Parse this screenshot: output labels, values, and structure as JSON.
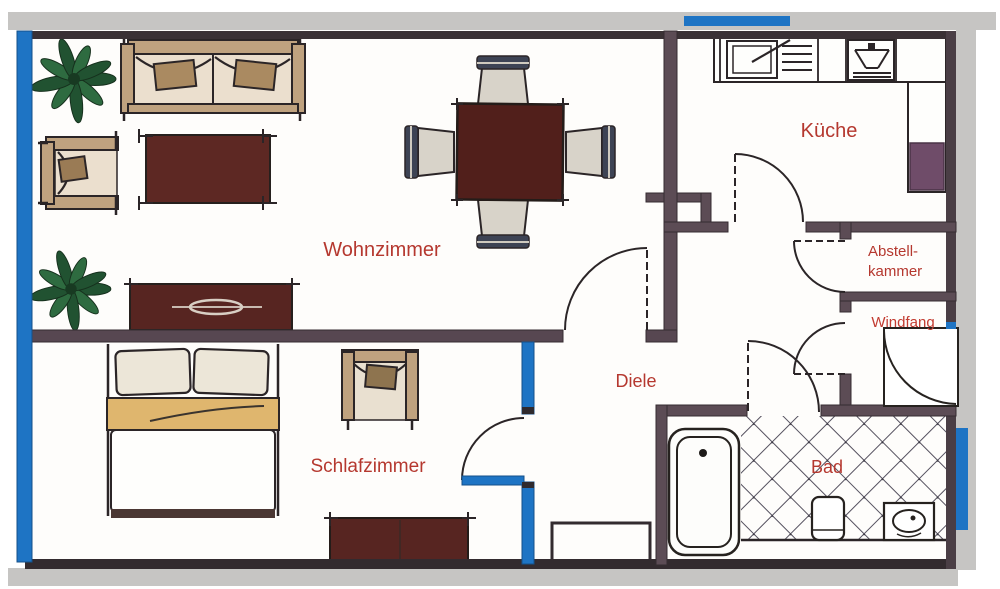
{
  "rooms": {
    "wohnzimmer": {
      "label": "Wohnzimmer"
    },
    "kueche": {
      "label": "Küche"
    },
    "schlafzimmer": {
      "label": "Schlafzimmer"
    },
    "diele": {
      "label": "Diele"
    },
    "bad": {
      "label": "Bad"
    },
    "abstellkammer": {
      "label_line1": "Abstell-",
      "label_line2": "kammer"
    },
    "windfang": {
      "label": "Windfang"
    }
  },
  "colors": {
    "label_red": "#b5382f",
    "windfang_red": "#c23b30",
    "accent_blue": "#1e74c4",
    "wall_dark": "#382f34",
    "wall_medium": "#5c4c55",
    "border_gray": "#c6c5c3",
    "furniture_maroon": "#572521",
    "furniture_tan": "#bfa27f",
    "seat_cream": "#ebdfce",
    "plant_green": "#215231",
    "chair_band_navy": "#3d4354",
    "appliance_purple": "#6f4c69"
  },
  "furniture_icons": [
    "potted-plant-icon",
    "sofa-icon",
    "armchair-icon",
    "rug-icon",
    "dining-table-icon",
    "dining-chair-icon",
    "sideboard-icon",
    "double-bed-icon",
    "dresser-icon",
    "console-table-icon",
    "bathtub-icon",
    "toilet-icon",
    "washbasin-icon",
    "kitchen-sink-icon",
    "stove-icon",
    "kitchen-counter-icon",
    "door-swing-icon"
  ]
}
